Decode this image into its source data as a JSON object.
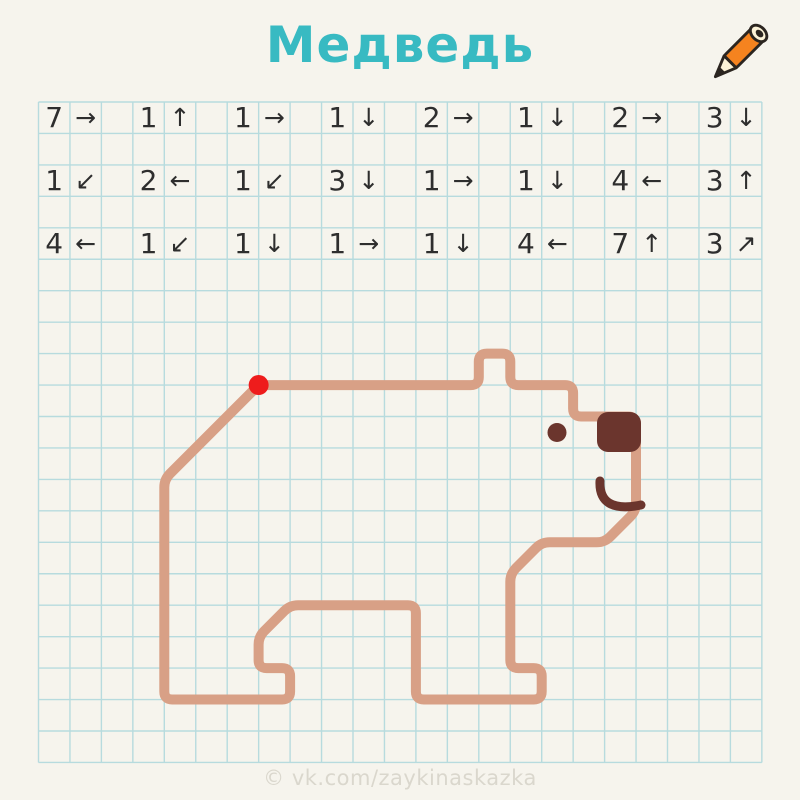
{
  "header": {
    "title": "Медведь"
  },
  "footer": {
    "watermark": "© vk.com/zaykinaskazka"
  },
  "colors": {
    "background": "#f6f4ed",
    "grid_line": "#b7dbde",
    "title": "#38bac2",
    "instruction_text": "#2e2e2e",
    "bear_outline": "#d8a086",
    "bear_dark": "#6b352d",
    "start_dot": "#ee1c1c",
    "pencil_orange": "#f5831f",
    "pencil_cream": "#fbf2d7",
    "pencil_black": "#2b2520",
    "watermark": "#dad7cd"
  },
  "grid": {
    "origin_x": 38.5,
    "origin_y": 102,
    "cell": 31.45,
    "cols": 23,
    "rows": 21
  },
  "arrow_glyphs": {
    "right": "→",
    "left": "←",
    "up": "↑",
    "down": "↓",
    "down-left": "↙",
    "up-right": "↗"
  },
  "instructions": {
    "rows": [
      [
        {
          "count": 7,
          "dir": "right"
        },
        {
          "count": 1,
          "dir": "up"
        },
        {
          "count": 1,
          "dir": "right"
        },
        {
          "count": 1,
          "dir": "down"
        },
        {
          "count": 2,
          "dir": "right"
        },
        {
          "count": 1,
          "dir": "down"
        },
        {
          "count": 2,
          "dir": "right"
        },
        {
          "count": 3,
          "dir": "down"
        }
      ],
      [
        {
          "count": 1,
          "dir": "down-left"
        },
        {
          "count": 2,
          "dir": "left"
        },
        {
          "count": 1,
          "dir": "down-left"
        },
        {
          "count": 3,
          "dir": "down"
        },
        {
          "count": 1,
          "dir": "right"
        },
        {
          "count": 1,
          "dir": "down"
        },
        {
          "count": 4,
          "dir": "left"
        },
        {
          "count": 3,
          "dir": "up"
        }
      ],
      [
        {
          "count": 4,
          "dir": "left"
        },
        {
          "count": 1,
          "dir": "down-left"
        },
        {
          "count": 1,
          "dir": "down"
        },
        {
          "count": 1,
          "dir": "right"
        },
        {
          "count": 1,
          "dir": "down"
        },
        {
          "count": 4,
          "dir": "left"
        },
        {
          "count": 7,
          "dir": "up"
        },
        {
          "count": 3,
          "dir": "up-right"
        }
      ]
    ]
  },
  "drawing": {
    "start_node": {
      "col": 7,
      "row": 9
    },
    "moves": [
      {
        "count": 7,
        "dir": "right"
      },
      {
        "count": 1,
        "dir": "up"
      },
      {
        "count": 1,
        "dir": "right"
      },
      {
        "count": 1,
        "dir": "down"
      },
      {
        "count": 2,
        "dir": "right"
      },
      {
        "count": 1,
        "dir": "down"
      },
      {
        "count": 2,
        "dir": "right"
      },
      {
        "count": 3,
        "dir": "down"
      },
      {
        "count": 1,
        "dir": "down-left"
      },
      {
        "count": 2,
        "dir": "left"
      },
      {
        "count": 1,
        "dir": "down-left"
      },
      {
        "count": 3,
        "dir": "down"
      },
      {
        "count": 1,
        "dir": "right"
      },
      {
        "count": 1,
        "dir": "down"
      },
      {
        "count": 4,
        "dir": "left"
      },
      {
        "count": 3,
        "dir": "up"
      },
      {
        "count": 4,
        "dir": "left"
      },
      {
        "count": 1,
        "dir": "down-left"
      },
      {
        "count": 1,
        "dir": "down"
      },
      {
        "count": 1,
        "dir": "right"
      },
      {
        "count": 1,
        "dir": "down"
      },
      {
        "count": 4,
        "dir": "left"
      },
      {
        "count": 7,
        "dir": "up"
      },
      {
        "count": 3,
        "dir": "up-right"
      }
    ],
    "stroke_width": 10,
    "corner_radius": 8,
    "features": {
      "eye": {
        "cx": 557,
        "cy": 432.5,
        "r": 9.5
      },
      "nose": {
        "x": 597,
        "y": 412,
        "w": 44,
        "h": 40,
        "rx": 11
      },
      "mouth_d": "M600 481 C599 502 612 511 641 505",
      "start_dot_r": 10
    }
  }
}
